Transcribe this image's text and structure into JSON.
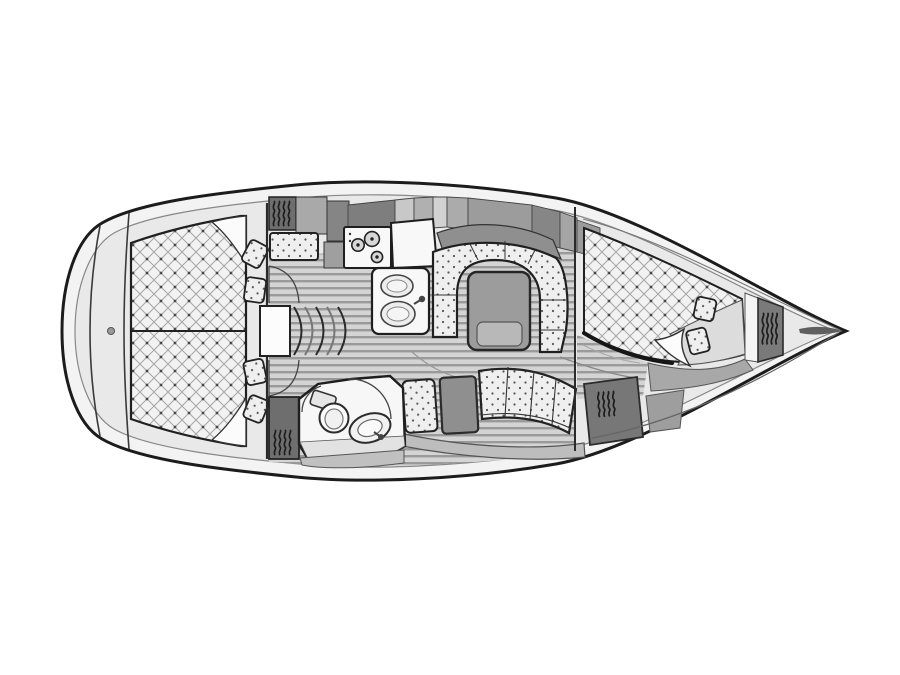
{
  "diagram": {
    "kind": "sailing-yacht interior floor plan, top view",
    "orientation": {
      "bow": "right",
      "stern": "left"
    },
    "background": "#ffffff"
  },
  "features": {
    "aft_cabin": {
      "berth": "full-beam double berth, diamond-quilted",
      "pillows": 4
    },
    "forward_cabin": {
      "berth": "angled double berth, diamond-quilted",
      "pillows": 2
    },
    "galley": {
      "stove_burners": 3,
      "sink_basins": 2
    },
    "head": {
      "fixtures": [
        "toilet",
        "washbasin"
      ],
      "door_arcs": 2
    },
    "salon": {
      "table": 1,
      "u_settee": 1,
      "bottom_settee_cushions": 3,
      "side_seat": 1
    },
    "hanging_lockers": 5,
    "companionway_steps": 5,
    "floor": "striped plank sole"
  },
  "colors": {
    "bg": "#ffffff",
    "hull-line": "#1c1c1c",
    "hull-band": "#f3f3f3",
    "interior": "#e9e9e9",
    "inner-line": "#888888",
    "berth": "#f2f2f2",
    "quilt-line": "#a6a6a6",
    "quilt-dot": "#4a4a4a",
    "cushion": "#efefef",
    "cushion-dot": "#555555",
    "plank-light": "#d4d4d4",
    "plank-dark": "#9a9a9a",
    "cabinet-dark": "#7e7e7e",
    "cabinet-mid": "#a5a5a5",
    "cabinet-light": "#cdcdcd",
    "locker": "#6e6e6e",
    "hanger": "#1d1d1d",
    "fixture": "#f8f8f8",
    "table": "#9c9c9c",
    "table-inner": "#b8b8b8",
    "seat": "#8f8f8f",
    "base-band": "#bdbdbd",
    "sheet": "#dcdcdc",
    "sliver": "#5f5f5f"
  }
}
